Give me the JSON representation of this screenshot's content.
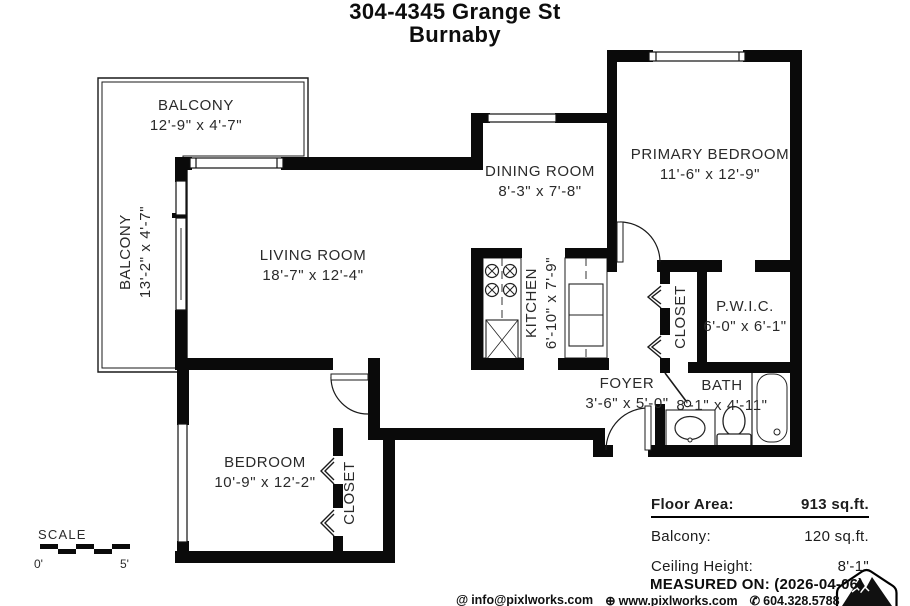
{
  "title": {
    "line1": "304-4345 Grange St",
    "line2": "Burnaby"
  },
  "rooms": {
    "balcony_top": {
      "name": "BALCONY",
      "dims": "12'-9\" x 4'-7\""
    },
    "balcony_left": {
      "name": "BALCONY",
      "dims": "13'-2\" x 4'-7\""
    },
    "living": {
      "name": "LIVING ROOM",
      "dims": "18'-7\" x 12'-4\""
    },
    "dining": {
      "name": "DINING ROOM",
      "dims": "8'-3\" x 7'-8\""
    },
    "primary": {
      "name": "PRIMARY BEDROOM",
      "dims": "11'-6\" x 12'-9\""
    },
    "kitchen": {
      "name": "KITCHEN",
      "dims": "6'-10\" x 7'-9\""
    },
    "closet_primary": {
      "name": "CLOSET"
    },
    "pwic": {
      "name": "P.W.I.C.",
      "dims": "6'-0\" x 6'-1\""
    },
    "foyer": {
      "name": "FOYER",
      "dims": "3'-6\" x 5'-0\""
    },
    "bath": {
      "name": "BATH",
      "dims": "8'-1\" x 4'-11\""
    },
    "bedroom": {
      "name": "BEDROOM",
      "dims": "10'-9\" x 12'-2\""
    },
    "closet_bedroom": {
      "name": "CLOSET"
    }
  },
  "scale": {
    "label": "SCALE",
    "start": "0'",
    "end": "5'"
  },
  "summary": {
    "floor_area_label": "Floor Area:",
    "floor_area_value": "913 sq.ft.",
    "balcony_label": "Balcony:",
    "balcony_value": "120 sq.ft.",
    "ceiling_label": "Ceiling Height:",
    "ceiling_value": "8'-1\"",
    "measured_on": "MEASURED ON: (2026-04-06)"
  },
  "contact": {
    "email_icon": "@",
    "email": "info@pixlworks.com",
    "web_icon": "⊕",
    "web": "www.pixlworks.com",
    "phone_icon": "✆",
    "phone": "604.328.5788"
  },
  "colors": {
    "ink": "#000000",
    "paper": "#ffffff"
  }
}
